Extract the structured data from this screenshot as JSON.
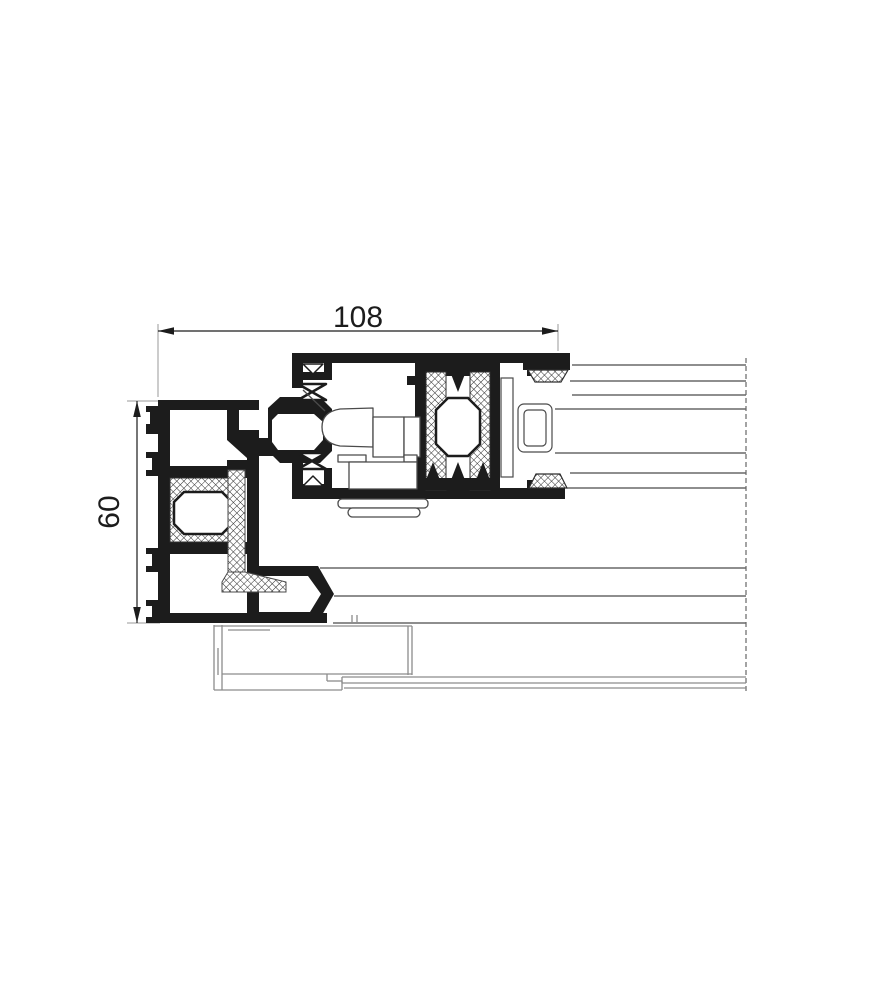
{
  "page": {
    "type": "technical-cad-section-drawing",
    "background": "#ffffff",
    "title": "Aluminium sliding window frame and sash cross-section"
  },
  "dimensions": {
    "width": {
      "label": "108",
      "orientation": "horizontal",
      "units_shown": false
    },
    "height": {
      "label": "60",
      "orientation": "vertical",
      "units_shown": false
    }
  },
  "colors": {
    "profile_black": "#1c1c1c",
    "thin_line": "#4a4a4a",
    "sill_line": "#8c8c8c",
    "extension_line": "#9a9a9a",
    "hatch_line": "#2e2e2e",
    "background": "#ffffff"
  },
  "components": [
    "outer-frame-profile",
    "sash-profile",
    "thermal-break-hatched",
    "center-gasket-strip",
    "bulb-gaskets",
    "locking-hardware-outline",
    "glazing-unit-lines",
    "glazing-block",
    "sill-track-outline",
    "section-break-dashed-line"
  ]
}
